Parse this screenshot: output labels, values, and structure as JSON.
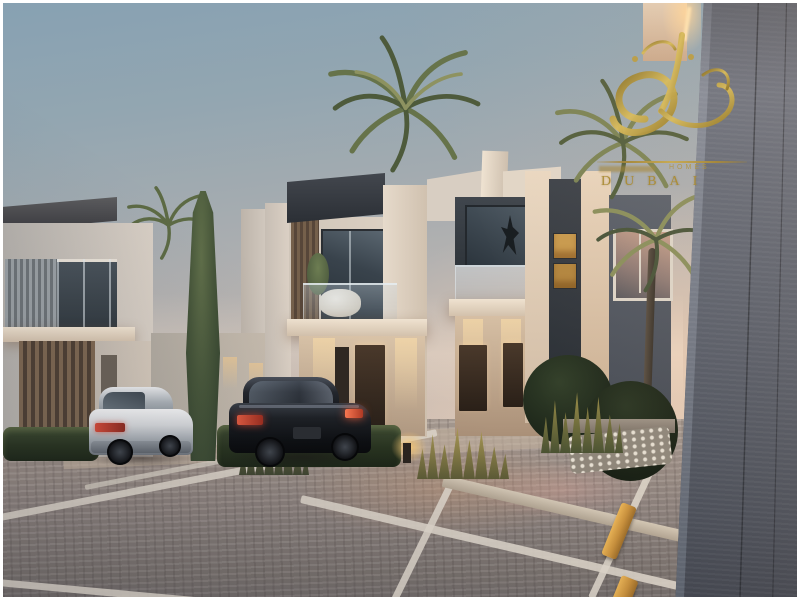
{
  "watermark": {
    "calligraphy": "gold-arabic-calligraphy-monogram",
    "tagline_word": "HOMES",
    "city": "DUBAI",
    "gold_color": "#b2943d"
  },
  "scene": {
    "setting": "modern-townhouse-community-at-dusk",
    "sky": {
      "top": "#87a1b2",
      "horizon": "#ead8c8"
    },
    "buildings": {
      "wall_white": "#ddd2c6",
      "wall_charcoal": "#33373d",
      "wood_louver": "#75604b",
      "door_brown": "#3a2d22",
      "lit_window": "#c89a4e",
      "foreground_wall": "#575d69"
    },
    "vehicles": [
      {
        "name": "white-sedan",
        "color": "#d5d7da"
      },
      {
        "name": "black-sedan",
        "color": "#16181c"
      }
    ],
    "vegetation": {
      "palm": "#6f7c50",
      "cypress": "#4c5c40",
      "hedge": "#2c3824",
      "lit_grass": "#b3a058"
    },
    "ground": {
      "cobblestone": "#9a8e88",
      "parking_line": "#ded6ca",
      "wheel_stop_yellow": "#d9a84e",
      "curb": "#cfc3b2"
    }
  }
}
